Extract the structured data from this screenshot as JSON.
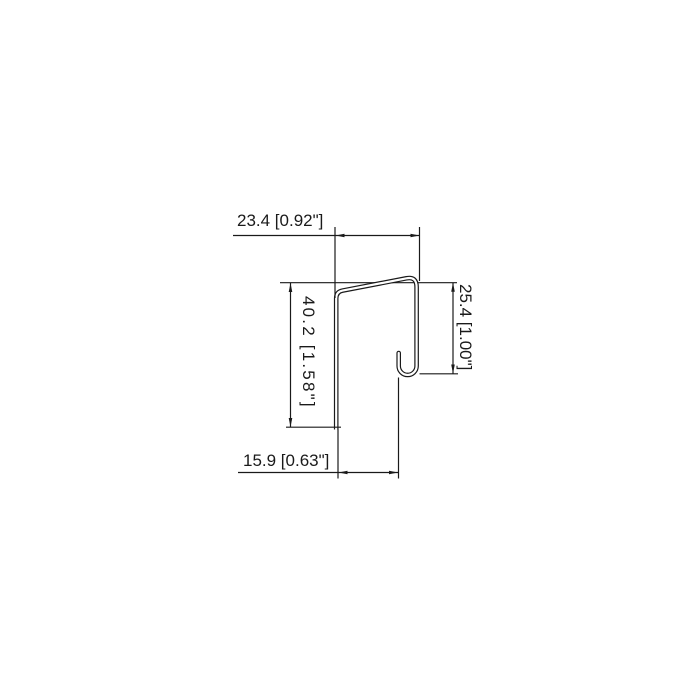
{
  "drawing": {
    "type": "technical-dimension-drawing",
    "units": "mm [inch]",
    "background_color": "#ffffff",
    "line_color": "#1a1a1a",
    "dims": {
      "top": {
        "label": "23.4 [0.92\"]",
        "mm": 23.4,
        "inches": 0.92
      },
      "left": {
        "label": "40.2 [1.58\"]",
        "mm": 40.2,
        "inches": 1.58
      },
      "right": {
        "label": "25.4 [1.00\"]",
        "mm": 25.4,
        "inches": 1.0
      },
      "bottom": {
        "label": "15.9 [0.63\"]",
        "mm": 15.9,
        "inches": 0.63
      }
    }
  }
}
